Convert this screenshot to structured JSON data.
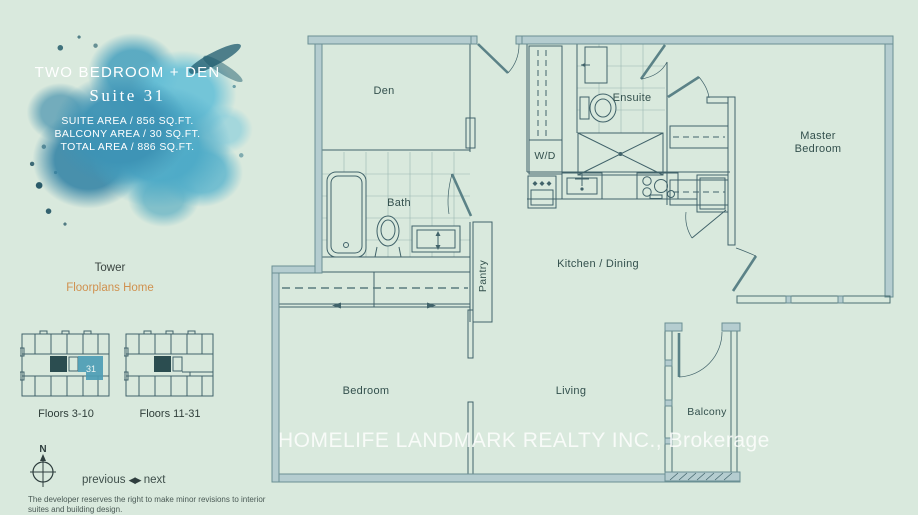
{
  "sidebar": {
    "suite": {
      "title": "TWO BEDROOM + DEN",
      "name": "Suite 31",
      "area_lines": [
        "SUITE AREA / 856 SQ.FT.",
        "BALCONY AREA / 30 SQ.FT.",
        "TOTAL AREA / 886 SQ.FT."
      ]
    },
    "tower_label": "Tower",
    "floorplans_link": "Floorplans Home",
    "keyplates": [
      {
        "label": "Floors 3-10",
        "unit": "31"
      },
      {
        "label": "Floors 11-31"
      }
    ],
    "compass_n": "N",
    "pager": {
      "previous": "previous",
      "next": "next"
    },
    "icons": {
      "prev_arrow": "◀",
      "next_arrow": "▶"
    },
    "disclaimer": "The developer reserves the right to make minor revisions to interior suites and building design."
  },
  "floorplan": {
    "rooms": {
      "den": "Den",
      "bath": "Bath",
      "ensuite": "Ensuite",
      "wd": "W/D",
      "pantry": "Pantry",
      "kitchen_dining": "Kitchen / Dining",
      "master_line1": "Master",
      "master_line2": "Bedroom",
      "bedroom": "Bedroom",
      "living": "Living",
      "balcony": "Balcony"
    },
    "watermark": "HOMELIFE LANDMARK REALTY INC., Brokerage"
  },
  "colors": {
    "background": "#d9e9dd",
    "wall_fill": "#b5cdd0",
    "wall_edge": "#6a9094",
    "line": "#41636a",
    "accent_unit": "#4d9cb4",
    "link": "#d0914f",
    "blob_blue": "#3d93b5"
  }
}
